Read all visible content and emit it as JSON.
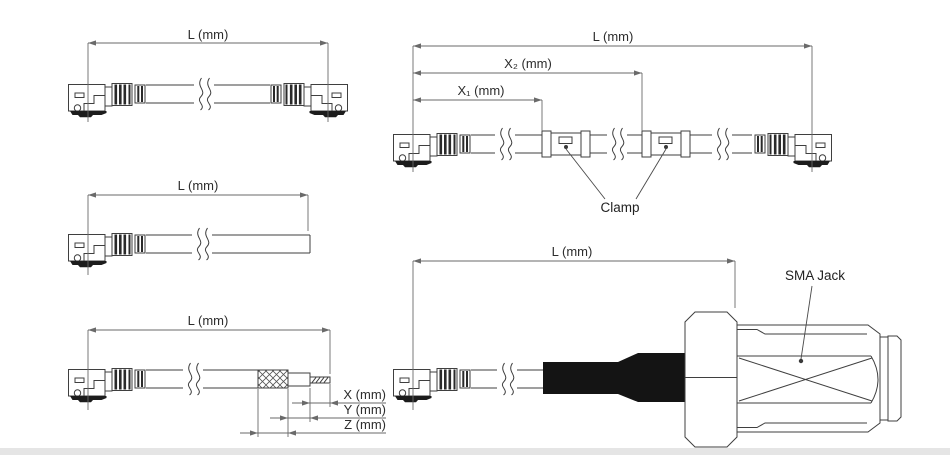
{
  "figures": {
    "double_ended": {
      "dim_l": "L (mm)"
    },
    "clamped": {
      "dim_l": "L (mm)",
      "dim_x2": "X₂ (mm)",
      "dim_x1": "X₁ (mm)",
      "clamp_label": "Clamp"
    },
    "open_end": {
      "dim_l": "L (mm)"
    },
    "stripped_end": {
      "dim_l": "L (mm)",
      "dim_x": "X (mm)",
      "dim_y": "Y (mm)",
      "dim_z": "Z (mm)"
    },
    "sma": {
      "dim_l": "L (mm)",
      "jack_label": "SMA Jack"
    }
  },
  "colors": {
    "background": "#ffffff",
    "drawing_line": "#3f3f3f",
    "dimension_line": "#6a6a6a",
    "text": "#2d2d2d",
    "solid_fill": "#141414",
    "bottom_strip": "#e5e5e5"
  }
}
